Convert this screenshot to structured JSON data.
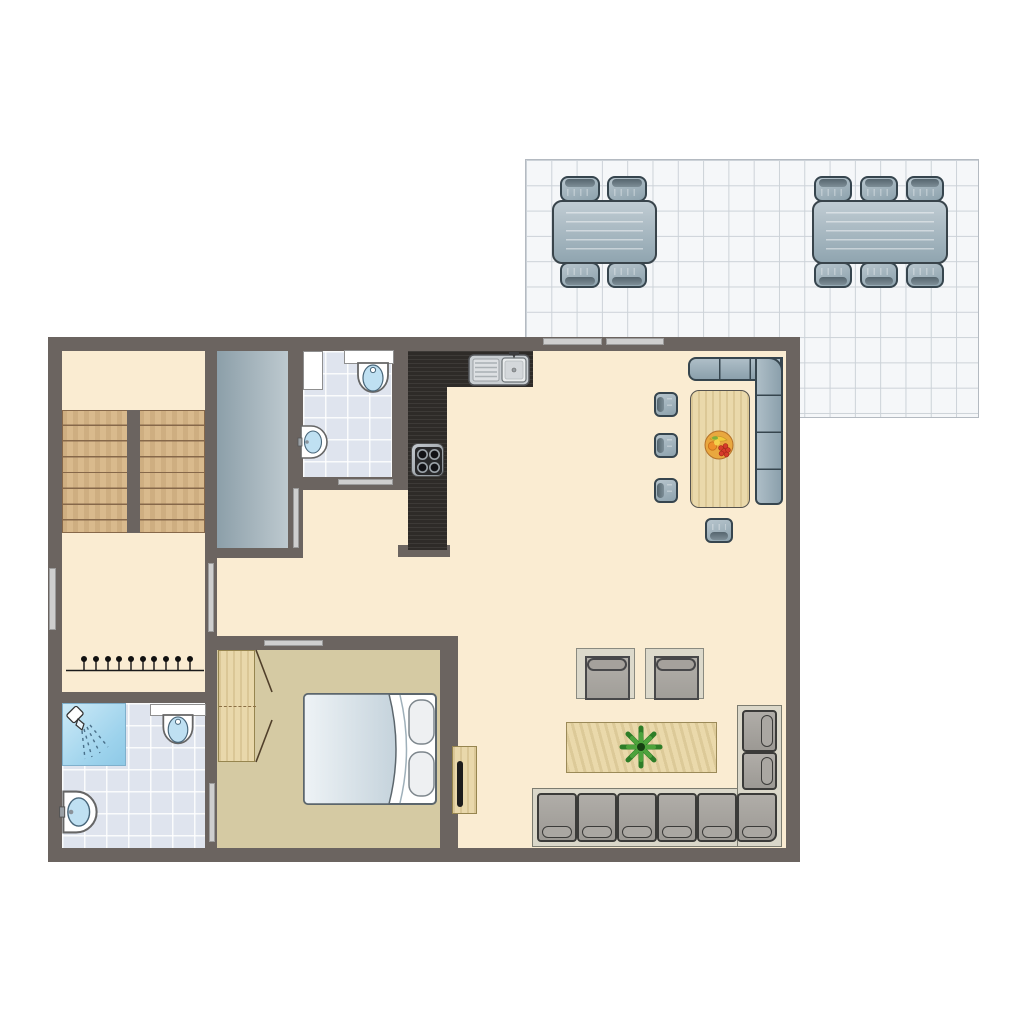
{
  "document": {
    "kind": "apartment floor plan (top view), no text labels visible",
    "visible_text": []
  },
  "colors": {
    "wall": "#6b6460",
    "floor_main": "#faecd2",
    "floor_bedroom": "#d5caa3",
    "floor_bathroom_tile": "#dfe4ee",
    "shower_blue": "#9cd2ec",
    "stair_wood": "#d9ba8d",
    "light_wood": "#e9d8ab",
    "kitchen_counter_dark": "#2e2b28",
    "furniture_blue_gray": "#9fb2bd",
    "furniture_outline": "#36454e",
    "sofa_gray": "#a5a29d",
    "sofa_frame": "#dad7c9",
    "terrace_tile": "#f5f7f9",
    "terrace_grid": "#ccd2d8",
    "opening_bar": "#cecece",
    "plant_green": "#2e7d28",
    "fruit_bowl_orange": "#e9a83f",
    "void_gray": "#9fb0b8"
  },
  "terrace": {
    "name": "tiled terrace",
    "tables": [
      {
        "name": "outdoor dining table",
        "seats": 4,
        "chairs_top": 2,
        "chairs_bottom": 2
      },
      {
        "name": "outdoor dining table",
        "seats": 6,
        "chairs_top": 3,
        "chairs_bottom": 3
      }
    ]
  },
  "rooms": [
    {
      "name": "hall with staircase",
      "furniture": [
        "double-flight staircase",
        "coat rack with 10 hooks"
      ]
    },
    {
      "name": "stairwell void / storage",
      "furniture": []
    },
    {
      "name": "toilet room",
      "furniture": [
        "cabinet",
        "toilet with cistern",
        "wall washbasin"
      ]
    },
    {
      "name": "kitchen",
      "furniture": [
        "L-shaped dark counter",
        "double sink with drainboard",
        "4-burner cooktop"
      ]
    },
    {
      "name": "living / dining area",
      "furniture": [
        "corner bench",
        "wooden dining table",
        "fruit bowl",
        "3 dining chairs left",
        "1 dining chair bottom",
        "2 armchairs",
        "wooden coffee table",
        "potted plant",
        "corner sofa",
        "TV cabinet"
      ]
    },
    {
      "name": "bedroom",
      "furniture": [
        "wardrobe with open doors",
        "double bed with 2 pillows"
      ]
    },
    {
      "name": "bathroom",
      "furniture": [
        "shower",
        "toilet with shelf",
        "washbasin"
      ]
    }
  ],
  "openings": {
    "windows": [
      "left wall window",
      "top wall window 1",
      "top wall window 2"
    ],
    "doors": [
      "hall door",
      "void-room door",
      "toilet-room door",
      "bedroom door",
      "bathroom door"
    ]
  }
}
